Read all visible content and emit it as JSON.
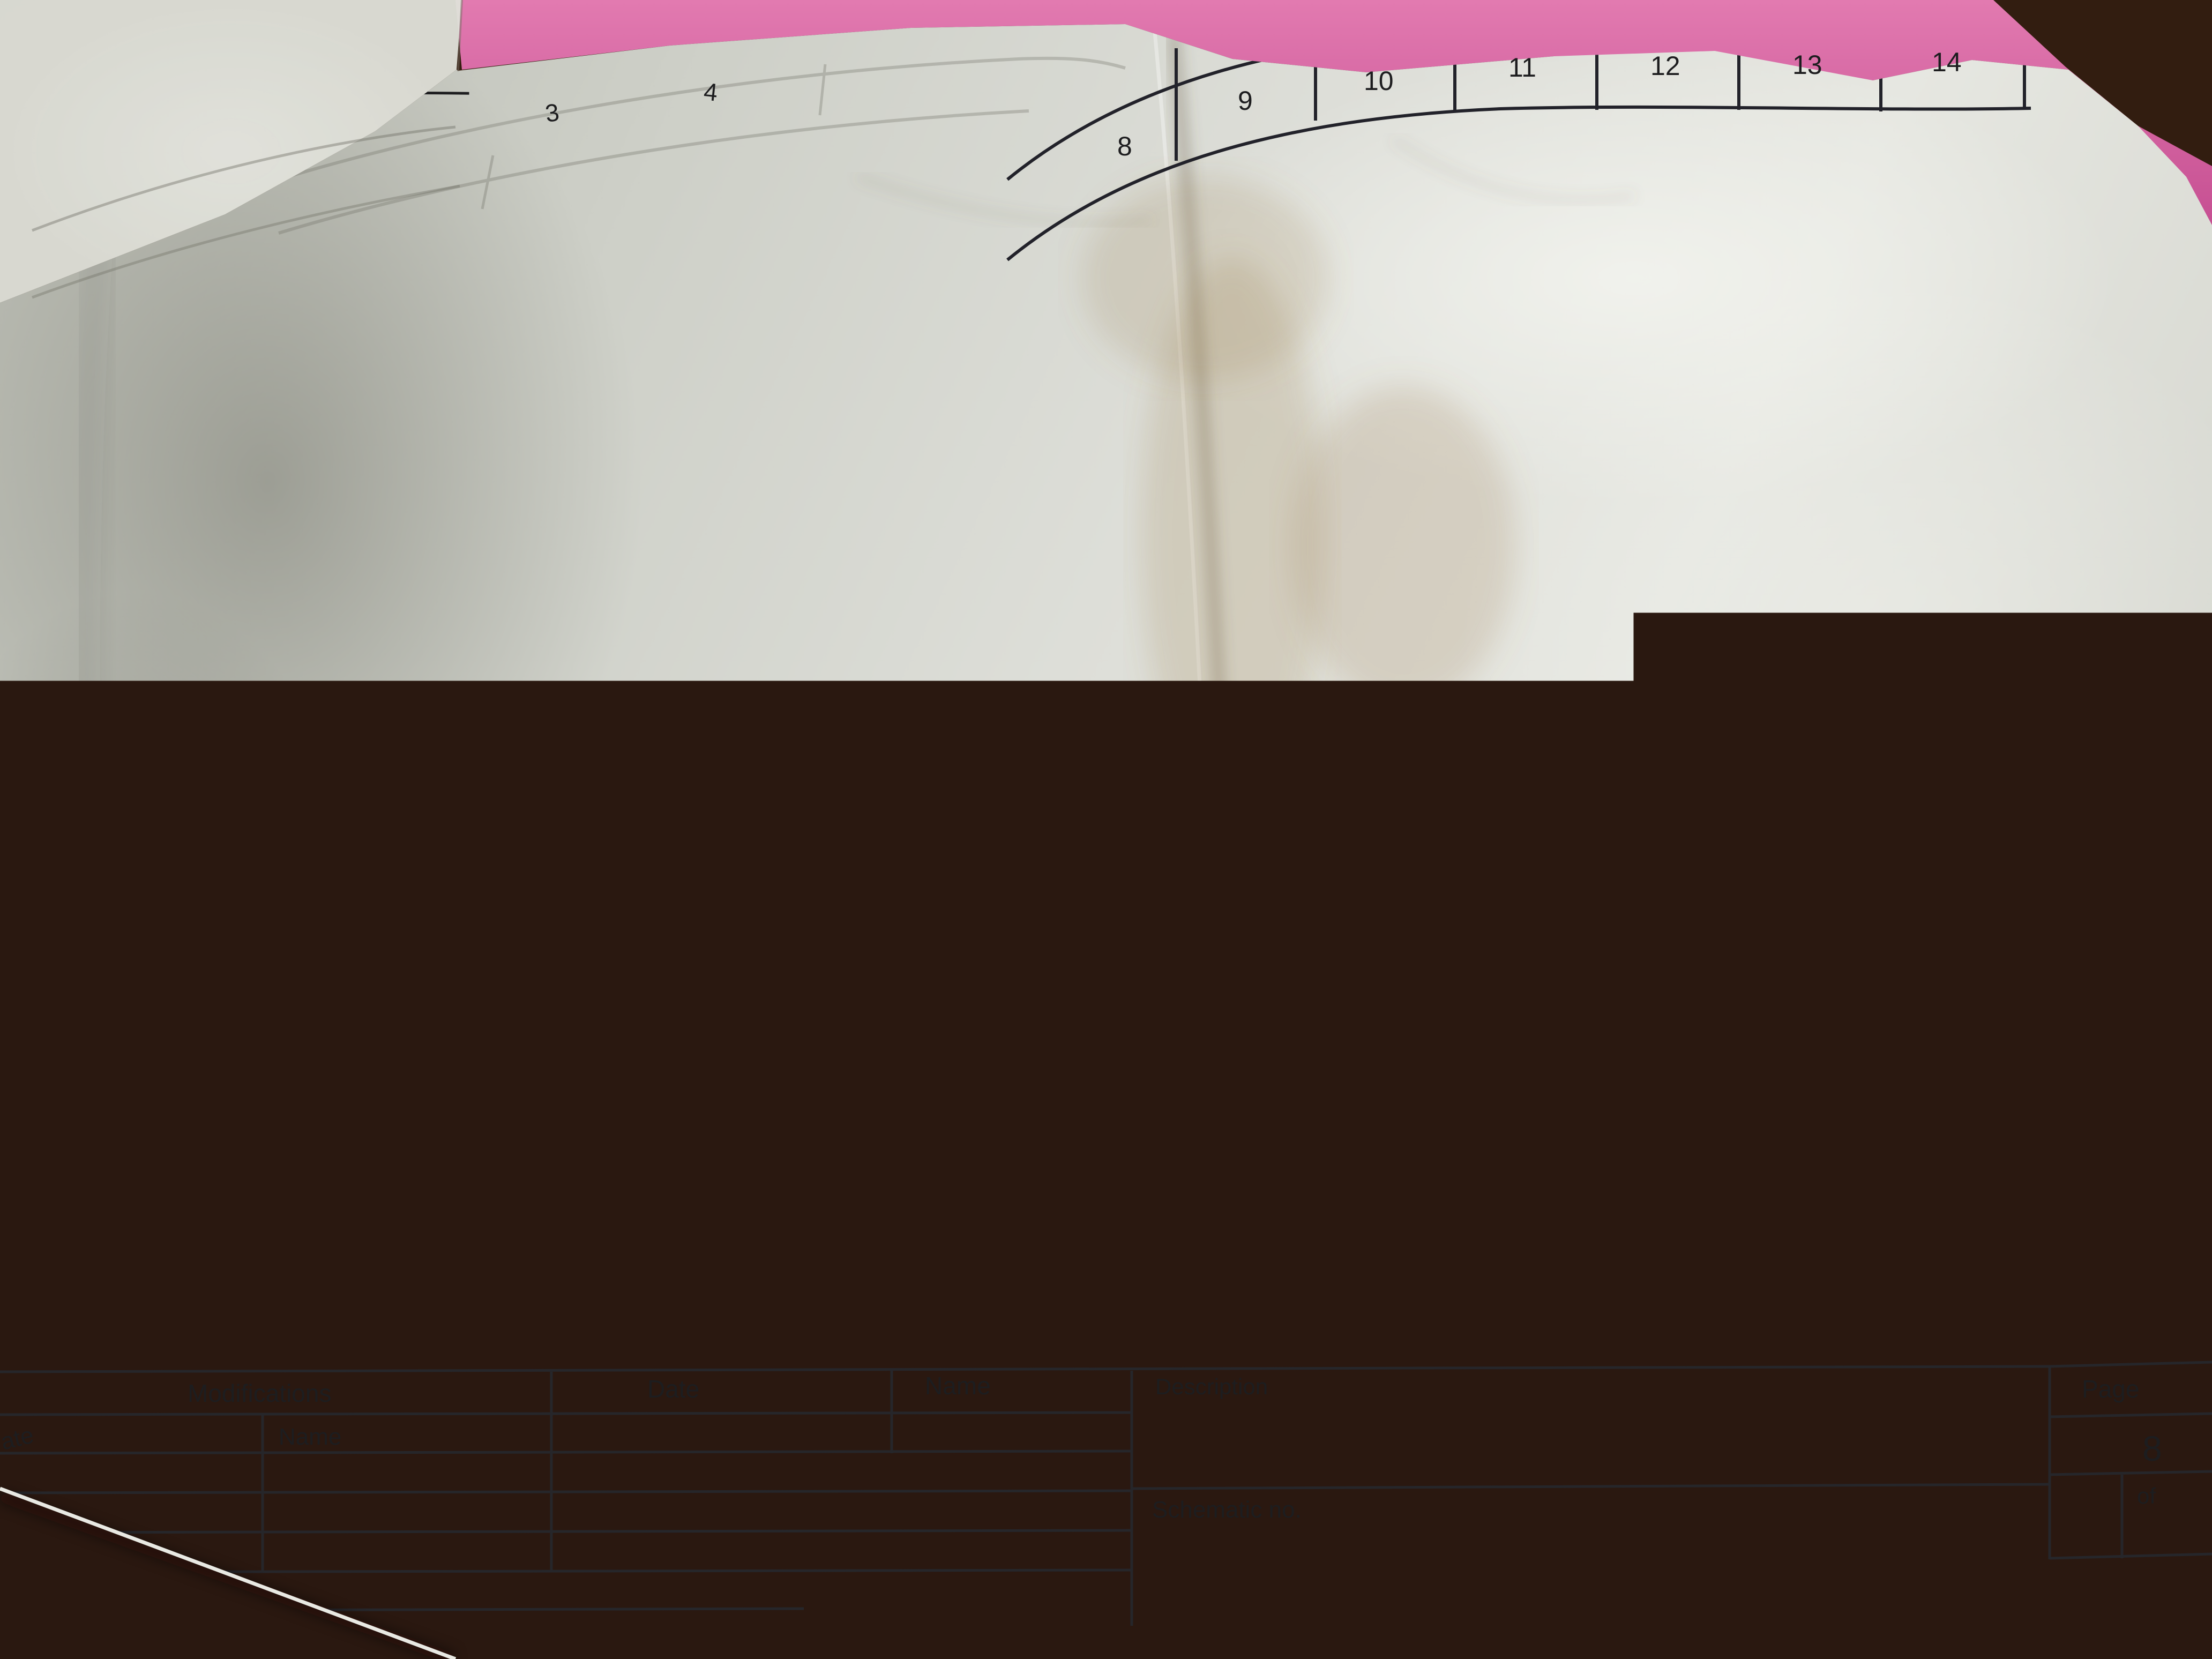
{
  "ruler": {
    "cells": [
      "8",
      "9",
      "10",
      "11",
      "12",
      "13",
      "14"
    ],
    "faint": [
      "3",
      "4"
    ]
  },
  "wires": {
    "n24_left": "24",
    "n724_left": "724",
    "n724_right": "724",
    "n24_right": "24",
    "n81": "81",
    "n82": "82",
    "n83": "83",
    "n84": "84",
    "n85": "85",
    "n87": "87",
    "n754": "754",
    "n1_gnd": "1",
    "n1_left_a": "1",
    "n1_left_b": "1",
    "n1_right": "1"
  },
  "components": {
    "k13": "K1.3",
    "pwr_on": "Pwr On",
    "x212": "X2.12",
    "km2": "KM2",
    "km3": "KM3",
    "k8": "K8",
    "x227": "X2.27",
    "xt24": "XT2.4",
    "sb7": "SB7",
    "sb8": "SB8",
    "sb9": "SB9",
    "p1": "P1",
    "p2": "P2",
    "p3": "P3",
    "y_coil": "Y",
    "k9_contact": "K9",
    "k9_coil": "K9",
    "vd15": "VD15",
    "vd16": "VD16",
    "vd17": "VD17",
    "vd18": "VD18",
    "tmr1": "TMR1",
    "plus24": "+24Vdc",
    "gnd": "GND",
    "x214": "X2.14",
    "x215": "X2.15"
  },
  "pins": {
    "a1": "A1",
    "a2": "A2",
    "t1": "1",
    "t2": "2"
  },
  "captions": {
    "clutch": "Муфта торм Z.",
    "tool": "Разжим инстр.",
    "part": "Разжим детали",
    "lube": "Смазка напр."
  },
  "titleblock": {
    "modifications": "Modifications",
    "name_row": "Name",
    "date": "Date",
    "name_col": "Name",
    "description": "Description",
    "schematic_no": "Schematic no.",
    "partial_date": "ate"
  },
  "page": {
    "page_label": "Page",
    "page_number": "8",
    "of_label": "of"
  },
  "colors": {
    "ink": "#1d1d1f",
    "paper": "#d6d7d0",
    "desk": "#402414",
    "pink": "#d45a9e",
    "stain_yellow": "#c8b93e"
  }
}
